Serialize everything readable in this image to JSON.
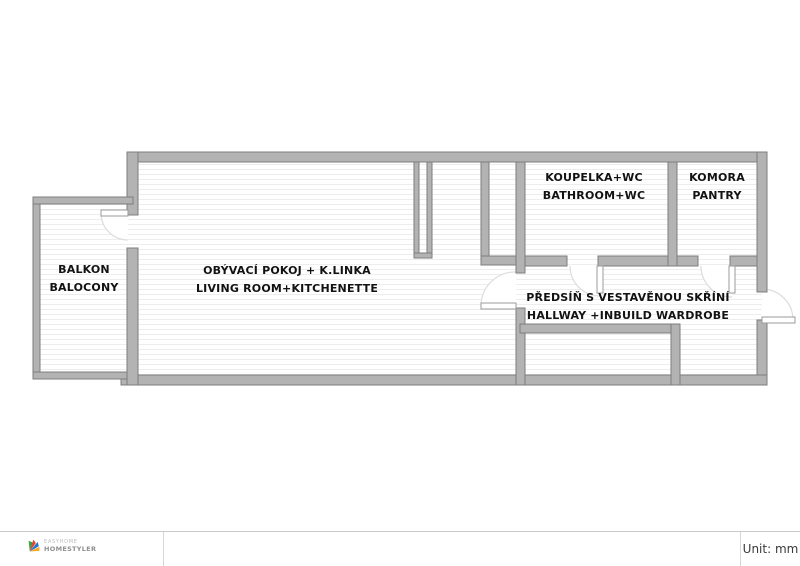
{
  "plan": {
    "wall_color": "#b3b3b3",
    "wall_edge_color": "#7e7e7e",
    "floor_stripe_color": "#ededed",
    "door_swing_color": "#dcdcdc",
    "rooms": [
      {
        "id": "balcony",
        "label_cs": "BALKON",
        "label_en": "BALOCONY"
      },
      {
        "id": "living-room",
        "label_cs": "OBÝVACÍ POKOJ + K.LINKA",
        "label_en": "LIVING ROOM+KITCHENETTE"
      },
      {
        "id": "bathroom",
        "label_cs": "KOUPELKA+WC",
        "label_en": "BATHROOM+WC"
      },
      {
        "id": "pantry",
        "label_cs": "KOMORA",
        "label_en": "PANTRY"
      },
      {
        "id": "hallway",
        "label_cs": "PŘEDSÍŇ S VESTAVĚNOU SKŘÍNÍ",
        "label_en": "HALLWAY +INBUILD WARDROBE"
      }
    ]
  },
  "footer": {
    "logo_line1": "EASYHOME",
    "logo_line2": "HOMESTYLER",
    "logo_colors": {
      "green": "#3fa14a",
      "red": "#e8452c",
      "blue": "#1976d2",
      "yellow": "#f9a825"
    },
    "unit_label": "Unit: mm"
  }
}
